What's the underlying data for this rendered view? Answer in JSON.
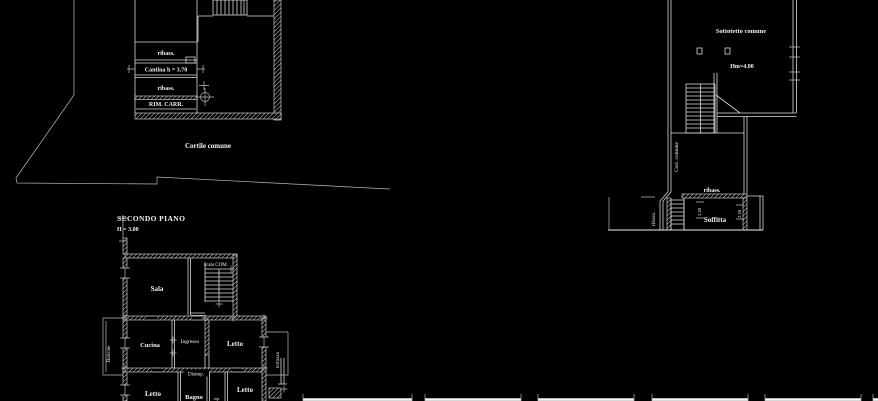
{
  "canvas": {
    "width": 878,
    "height": 401,
    "background": "#000000",
    "line_color": "#d9d9d9",
    "text_color": "#f2f2f2"
  },
  "ground_plan": {
    "courtyard_label": "Cortile comune",
    "room_band_top": "ribass.",
    "cantina_label": "Cantina h = 3.70",
    "room_band_bottom": "ribass.",
    "rimessa_label": "RIM. CARR."
  },
  "attic_plan": {
    "sottotetto_label": "Sottotetto comune",
    "height_label": "Hm=4.00",
    "corridor_label": "Corr. comune",
    "band_label": "ribass.",
    "soffitta_label": "Soffitta",
    "left_band_label": "ribass.",
    "dim_left": "2.20",
    "dim_right": "2.20"
  },
  "second_floor": {
    "title": "SECONDO PIANO",
    "height_note": "H = 3.00",
    "rooms": {
      "sala": "Sala",
      "scala": "scala COM.",
      "cucina": "Cucina",
      "ingresso": "Ingresso",
      "letto_right": "Letto",
      "balcone": "Balcone",
      "terrazza": "terrazza",
      "disimpegno": "Disimp.",
      "letto_bottom_left": "Letto",
      "bagno": "Bagno",
      "ripostiglio": "rip.",
      "letto_bottom_right": "Letto"
    }
  }
}
